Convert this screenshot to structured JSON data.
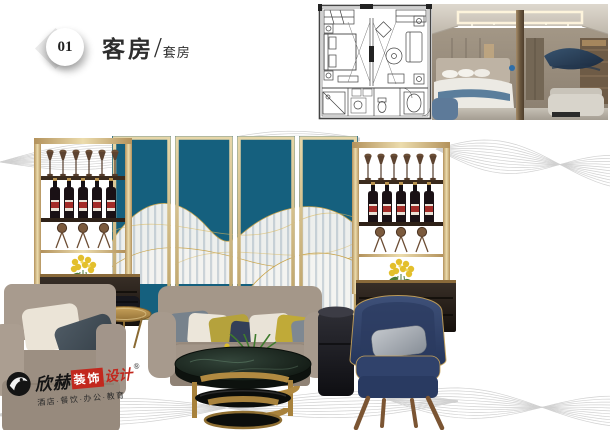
{
  "header": {
    "badge": "01",
    "title": "客房",
    "slash": "/",
    "subtitle": "套房"
  },
  "logo": {
    "brand_black": "欣赫",
    "brand_boxed": "装饰",
    "brand_red": "设计",
    "registered": "®",
    "tagline": "酒店·餐饮·办公·教育"
  },
  "colors": {
    "panel_teal": "#15607e",
    "frame_gold": "#cbb277",
    "logo_red": "#c2281e",
    "chair_navy": "#2d3e63",
    "sofa_taupe": "#9c8f82",
    "wave_gray": "#c6c6c6"
  }
}
